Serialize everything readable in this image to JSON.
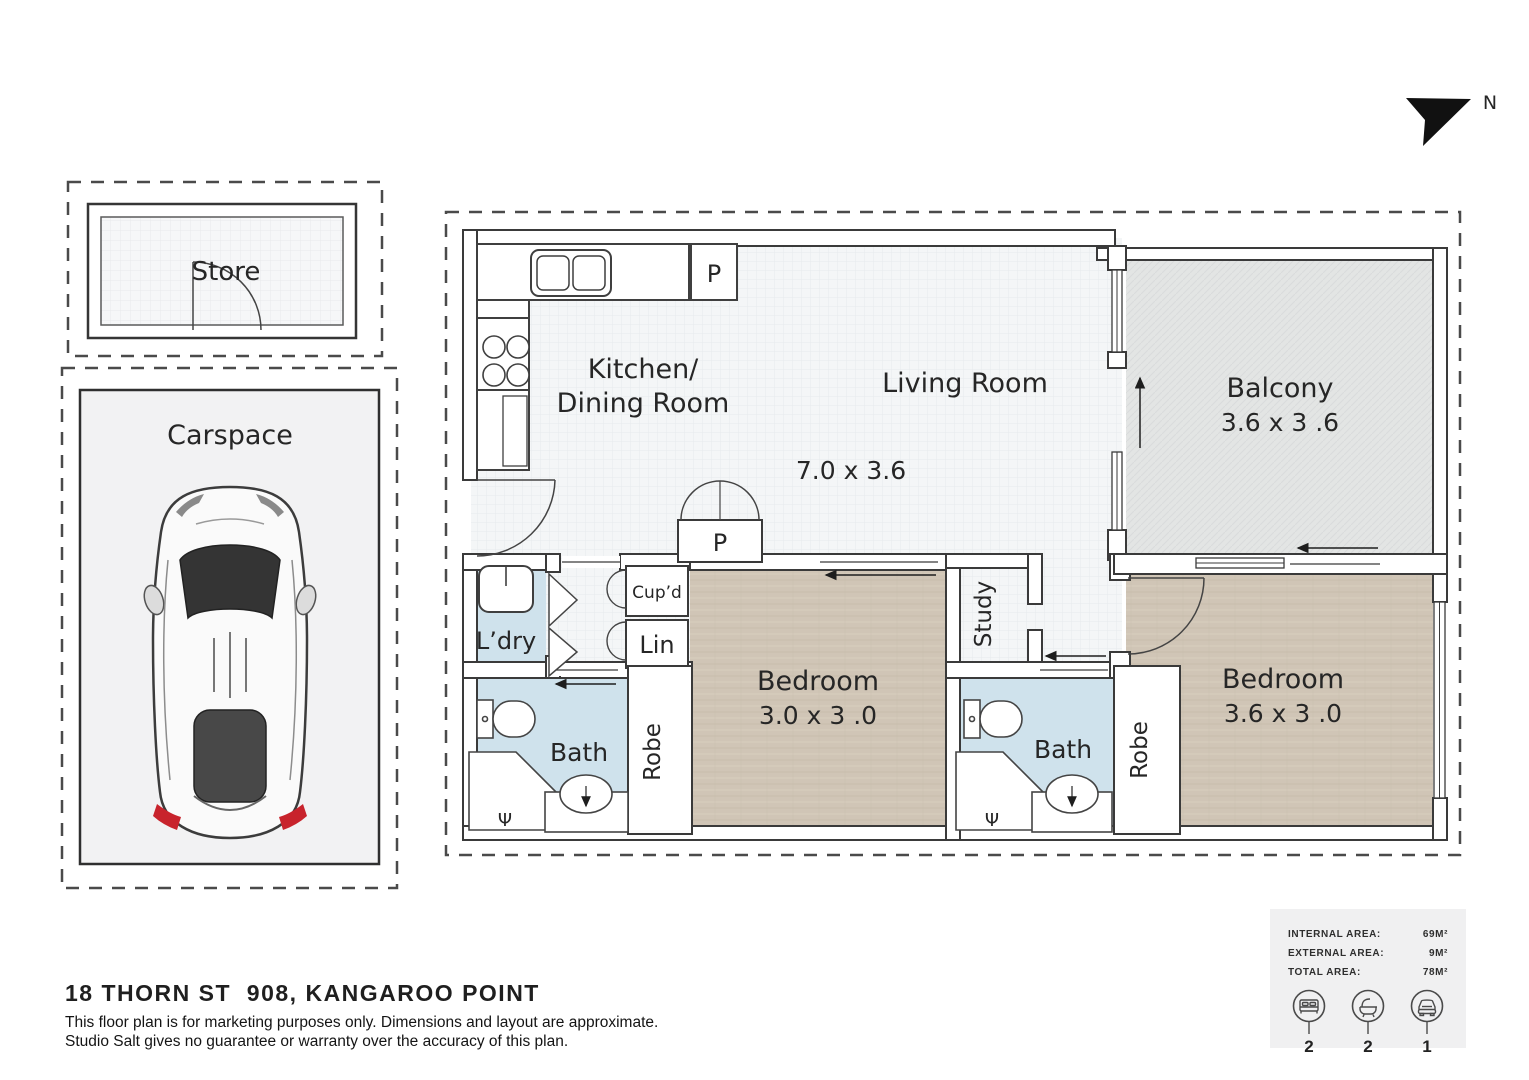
{
  "compass": {
    "label": "N"
  },
  "annex": {
    "store": {
      "label": "Store"
    },
    "carspace": {
      "label": "Carspace"
    }
  },
  "rooms": {
    "kitchen": {
      "line1": "Kitchen/",
      "line2": "Dining Room"
    },
    "living": {
      "label": "Living Room",
      "dims": "7.0 x 3.6"
    },
    "balcony": {
      "label": "Balcony",
      "dims": "3.6 x 3 .6"
    },
    "bedroom1": {
      "label": "Bedroom",
      "dims": "3.0 x 3 .0"
    },
    "bedroom2": {
      "label": "Bedroom",
      "dims": "3.6 x 3 .0"
    },
    "bath1": {
      "label": "Bath"
    },
    "bath2": {
      "label": "Bath"
    },
    "laundry": {
      "label": "L’dry"
    },
    "study": {
      "label": "Study"
    },
    "robe1": {
      "label": "Robe"
    },
    "robe2": {
      "label": "Robe"
    },
    "cupboard": {
      "label": "Cup’d"
    },
    "linen": {
      "label": "Lin"
    },
    "pantry_top": {
      "label": "P"
    },
    "pantry_hall": {
      "label": "P"
    },
    "shower_symbol": "Ψ"
  },
  "footer": {
    "address": "18 THORN ST  908, KANGAROO POINT",
    "disclaimer1": "This floor plan is for marketing purposes only. Dimensions and layout are approximate.",
    "disclaimer2": "Studio Salt gives no guarantee or warranty over the accuracy of this plan."
  },
  "stats": {
    "rows": [
      {
        "label": "INTERNAL AREA:",
        "value": "69M²"
      },
      {
        "label": "EXTERNAL AREA:",
        "value": "9M²"
      },
      {
        "label": "TOTAL AREA:",
        "value": "78M²"
      }
    ],
    "icons": [
      {
        "name": "bed-icon",
        "count": "2"
      },
      {
        "name": "bath-icon",
        "count": "2"
      },
      {
        "name": "car-icon",
        "count": "1"
      }
    ]
  },
  "colors": {
    "wood_floor": "#d0c5b6",
    "bath_floor": "#cfe2ec",
    "balcony_floor": "#e3e5e4",
    "interior_floor": "#f4f6f7",
    "wall_line": "#3a3a3a",
    "taillight_red": "#c8232c"
  }
}
